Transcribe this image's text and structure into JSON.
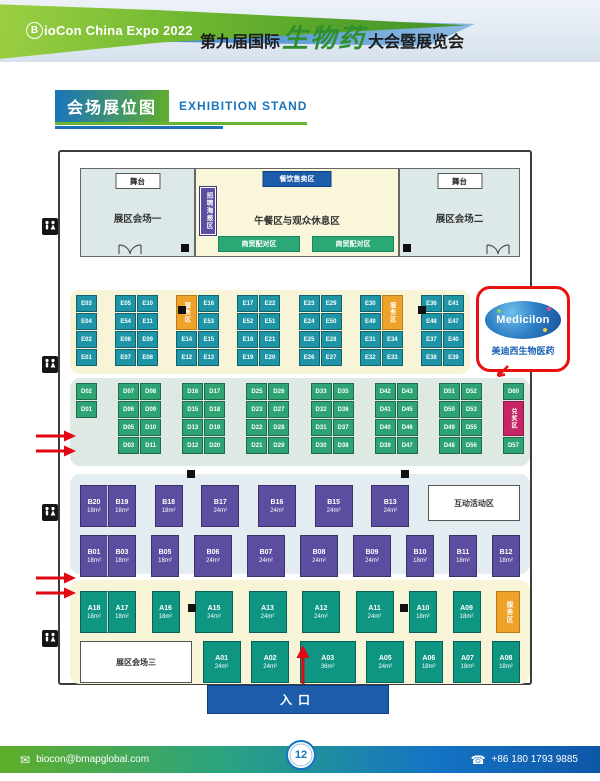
{
  "header": {
    "logo_b": "B",
    "logo_rest": "ioCon China Expo 2022",
    "title_prefix": "第九届国际",
    "title_script": "生物药",
    "title_suffix": "大会暨展览会"
  },
  "section_title": {
    "zh": "会场展位图",
    "en": "EXHIBITION STAND"
  },
  "plan": {
    "top": {
      "stage": "舞台",
      "hall1": "展区会场一",
      "hall2": "展区会场二",
      "food_label": "餐饮售卖区",
      "poster_label": "招聘海报区",
      "lunch_label": "午餐区与观众休息区",
      "matching_label": "商贸配对区"
    },
    "entrance": "入口",
    "e_section": {
      "groups": [
        {
          "cols": 1,
          "cells": [
            {
              "t": "E03"
            },
            {
              "t": "E04"
            },
            {
              "t": "E02"
            },
            {
              "t": "E01"
            }
          ]
        },
        {
          "cols": 2,
          "cells": [
            {
              "t": "E05"
            },
            {
              "t": "E54"
            },
            {
              "t": "E06"
            },
            {
              "t": "E07"
            },
            {
              "t": "E10"
            },
            {
              "t": "E11"
            },
            {
              "t": "E09"
            },
            {
              "t": "E08"
            }
          ]
        },
        {
          "cols": 2,
          "cells": [
            {
              "t": "服务区",
              "type": "service",
              "span": 2
            },
            {
              "t": "E14"
            },
            {
              "t": "E12"
            },
            {
              "t": "E16"
            },
            {
              "t": "E53"
            },
            {
              "t": "E15"
            },
            {
              "t": "E13"
            }
          ]
        },
        {
          "cols": 2,
          "cells": [
            {
              "t": "E17"
            },
            {
              "t": "E52"
            },
            {
              "t": "E18"
            },
            {
              "t": "E19"
            },
            {
              "t": "E22"
            },
            {
              "t": "E51"
            },
            {
              "t": "E21"
            },
            {
              "t": "E20"
            }
          ]
        },
        {
          "cols": 2,
          "cells": [
            {
              "t": "E23"
            },
            {
              "t": "E24"
            },
            {
              "t": "E25"
            },
            {
              "t": "E26"
            },
            {
              "t": "E29"
            },
            {
              "t": "E50"
            },
            {
              "t": "E28"
            },
            {
              "t": "E27"
            }
          ]
        },
        {
          "cols": 2,
          "cells": [
            {
              "t": "E30"
            },
            {
              "t": "E49"
            },
            {
              "t": "E31"
            },
            {
              "t": "E32"
            },
            {
              "t": "服务区",
              "type": "service",
              "span": 2
            },
            {
              "t": "E34"
            },
            {
              "t": "E33"
            }
          ]
        },
        {
          "cols": 2,
          "cells": [
            {
              "t": "E36"
            },
            {
              "t": "E48"
            },
            {
              "t": "E37"
            },
            {
              "t": "E38"
            },
            {
              "t": "E41"
            },
            {
              "t": "E47"
            },
            {
              "t": "E40"
            },
            {
              "t": "E39"
            }
          ]
        }
      ]
    },
    "d_section": {
      "groups": [
        {
          "cols": 1,
          "cells": [
            {
              "t": "D02"
            },
            {
              "t": "D01"
            }
          ]
        },
        {
          "cols": 2,
          "cells": [
            {
              "t": "D07"
            },
            {
              "t": "D06"
            },
            {
              "t": "D05"
            },
            {
              "t": "D03"
            },
            {
              "t": "D08"
            },
            {
              "t": "D09"
            },
            {
              "t": "D10"
            },
            {
              "t": "D11"
            }
          ]
        },
        {
          "cols": 2,
          "cells": [
            {
              "t": "D16"
            },
            {
              "t": "D15"
            },
            {
              "t": "D13"
            },
            {
              "t": "D12"
            },
            {
              "t": "D17"
            },
            {
              "t": "D18"
            },
            {
              "t": "D19"
            },
            {
              "t": "D20"
            }
          ]
        },
        {
          "cols": 2,
          "cells": [
            {
              "t": "D25"
            },
            {
              "t": "D23"
            },
            {
              "t": "D22"
            },
            {
              "t": "D21"
            },
            {
              "t": "D26"
            },
            {
              "t": "D27"
            },
            {
              "t": "D28"
            },
            {
              "t": "D29"
            }
          ]
        },
        {
          "cols": 2,
          "cells": [
            {
              "t": "D33"
            },
            {
              "t": "D32"
            },
            {
              "t": "D31"
            },
            {
              "t": "D30"
            },
            {
              "t": "D35"
            },
            {
              "t": "D36"
            },
            {
              "t": "D37"
            },
            {
              "t": "D38"
            }
          ]
        },
        {
          "cols": 2,
          "cells": [
            {
              "t": "D42"
            },
            {
              "t": "D41"
            },
            {
              "t": "D40"
            },
            {
              "t": "D39"
            },
            {
              "t": "D43"
            },
            {
              "t": "D45"
            },
            {
              "t": "D46"
            },
            {
              "t": "D47"
            }
          ]
        },
        {
          "cols": 2,
          "cells": [
            {
              "t": "D51"
            },
            {
              "t": "D50"
            },
            {
              "t": "D49"
            },
            {
              "t": "D48"
            },
            {
              "t": "D52"
            },
            {
              "t": "D53"
            },
            {
              "t": "D55"
            },
            {
              "t": "D56"
            }
          ]
        },
        {
          "cols": 1,
          "cells": [
            {
              "t": "D60"
            },
            {
              "t": "兑奖区",
              "type": "prize",
              "span": 2
            },
            {
              "t": "D57"
            }
          ]
        }
      ]
    },
    "b_section": {
      "rows": [
        [
          {
            "type": "pair",
            "booths": [
              {
                "l": "B20",
                "s": "18m²"
              },
              {
                "l": "B19",
                "s": "18m²"
              }
            ]
          },
          {
            "type": "booth",
            "l": "B18",
            "s": "18m²"
          },
          {
            "type": "booth",
            "l": "B17",
            "s": "24m²"
          },
          {
            "type": "booth",
            "l": "B16",
            "s": "24m²"
          },
          {
            "type": "booth",
            "l": "B15",
            "s": "24m²"
          },
          {
            "type": "booth",
            "l": "B13",
            "s": "24m²"
          },
          {
            "type": "box",
            "id": "interactive-zone",
            "label": "互动活动区",
            "w": 92,
            "h": 36
          }
        ],
        [
          {
            "type": "pair",
            "booths": [
              {
                "l": "B01",
                "s": "18m²"
              },
              {
                "l": "B03",
                "s": "18m²"
              }
            ]
          },
          {
            "type": "booth",
            "l": "B05",
            "s": "18m²"
          },
          {
            "type": "booth",
            "l": "B06",
            "s": "24m²"
          },
          {
            "type": "booth",
            "l": "B07",
            "s": "24m²"
          },
          {
            "type": "booth",
            "l": "B08",
            "s": "24m²"
          },
          {
            "type": "booth",
            "l": "B09",
            "s": "24m²"
          },
          {
            "type": "booth",
            "l": "B10",
            "s": "18m²"
          },
          {
            "type": "booth",
            "l": "B11",
            "s": "18m²"
          },
          {
            "type": "booth",
            "l": "B12",
            "s": "18m²"
          }
        ]
      ]
    },
    "a_section": {
      "rows": [
        [
          {
            "type": "pair",
            "booths": [
              {
                "l": "A18",
                "s": "18m²"
              },
              {
                "l": "A17",
                "s": "18m²"
              }
            ]
          },
          {
            "type": "booth",
            "l": "A16",
            "s": "18m²"
          },
          {
            "type": "booth",
            "l": "A15",
            "s": "24m²"
          },
          {
            "type": "booth",
            "l": "A13",
            "s": "24m²"
          },
          {
            "type": "booth",
            "l": "A12",
            "s": "24m²"
          },
          {
            "type": "booth",
            "l": "A11",
            "s": "24m²"
          },
          {
            "type": "booth",
            "l": "A10",
            "s": "18m²"
          },
          {
            "type": "booth",
            "l": "A09",
            "s": "18m²"
          },
          {
            "type": "service",
            "label": "服务区"
          }
        ],
        [
          {
            "type": "box",
            "id": "hall-three",
            "label": "展区会场三",
            "w": 112,
            "h": 42
          },
          {
            "type": "booth",
            "l": "A01",
            "s": "24m²"
          },
          {
            "type": "booth",
            "l": "A02",
            "s": "24m²"
          },
          {
            "type": "booth",
            "l": "A03",
            "s": "36m²"
          },
          {
            "type": "booth",
            "l": "A05",
            "s": "24m²"
          },
          {
            "type": "booth",
            "l": "A06",
            "s": "18m²"
          },
          {
            "type": "booth",
            "l": "A07",
            "s": "18m²"
          },
          {
            "type": "booth",
            "l": "A08",
            "s": "18m²"
          }
        ]
      ]
    }
  },
  "callout": {
    "brand": "Medicilon",
    "name": "美迪西生物医药"
  },
  "footer": {
    "email": "biocon@bmapglobal.com",
    "page": "12",
    "phone": "+86 180 1793 9885"
  },
  "colors": {
    "accent_blue": "#1c5cab",
    "accent_green": "#2aa876",
    "booth_e": "#1d95a6",
    "booth_d": "#2ea474",
    "booth_b": "#5b4d9f",
    "booth_a": "#0f9683",
    "service_orange": "#efa22a",
    "prize_pink": "#c62567",
    "callout_red": "#e8110f"
  }
}
